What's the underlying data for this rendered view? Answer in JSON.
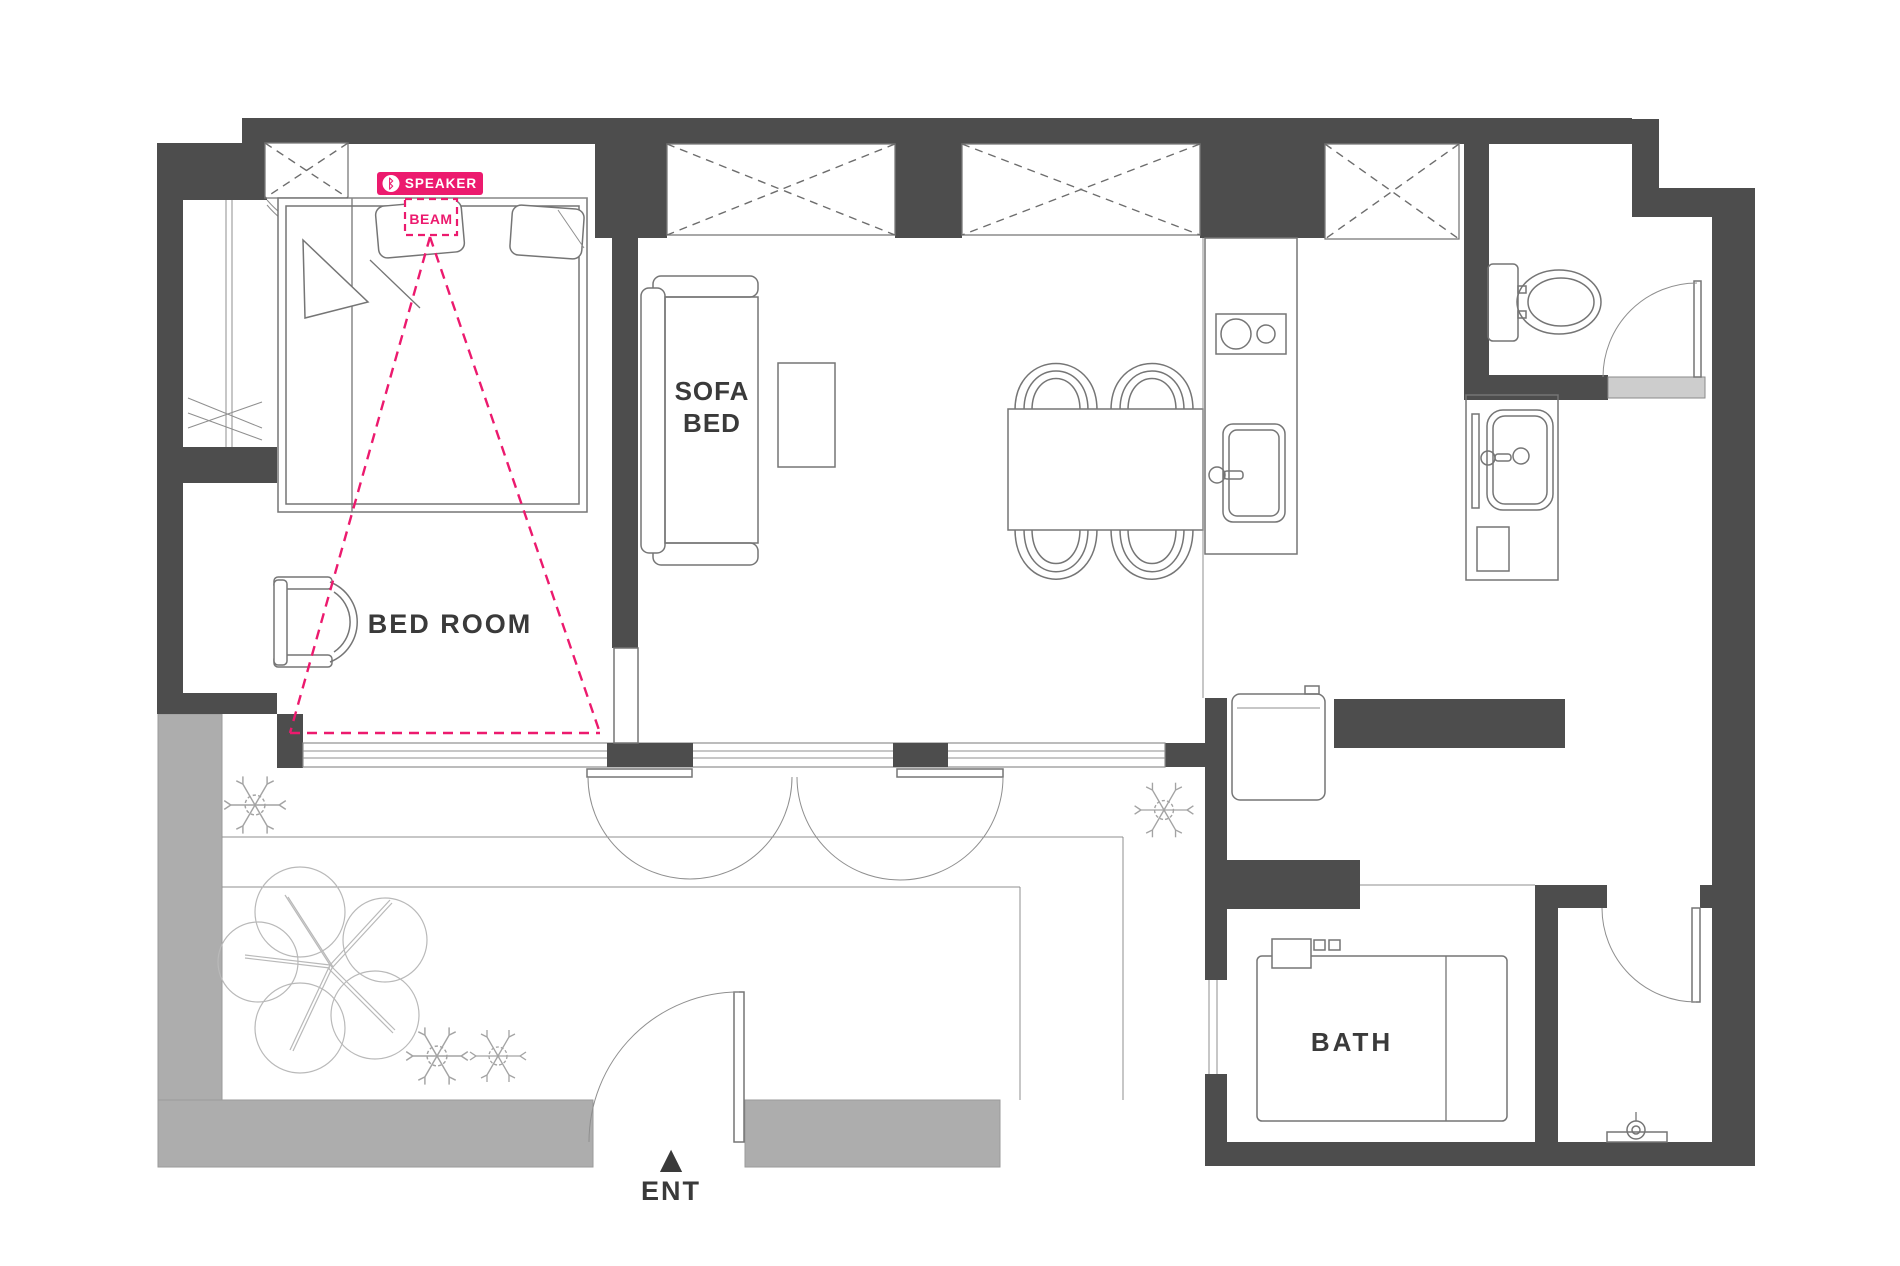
{
  "colors": {
    "wall": "#4D4D4D",
    "balcony": "#ADADAD",
    "sill": "#CDCDCD",
    "accent": "#EC1A6E",
    "text": "#3A3A3A",
    "line": "#757575",
    "tree": "#A3A3A3",
    "treebig": "#B9B9B9"
  },
  "speaker": {
    "label": "SPEAKER",
    "beam": "BEAM"
  },
  "icons": {
    "bluetooth": "ᛒ",
    "entrance_arrow": "▲"
  },
  "rooms": {
    "bedroom": "BED ROOM",
    "bath": "BATH",
    "entrance": "ENT"
  },
  "sofa_bed": {
    "line1": "SOFA",
    "line2": "BED"
  }
}
